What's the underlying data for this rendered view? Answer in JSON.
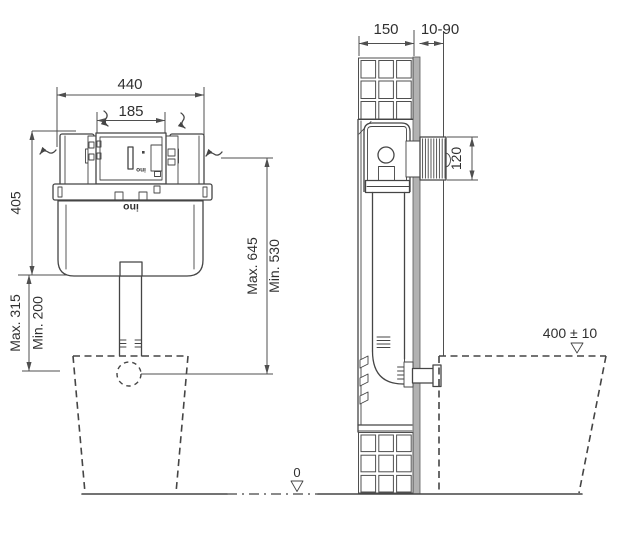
{
  "front_view": {
    "dim_frame_width": "440",
    "dim_access_width": "185",
    "dim_frame_height": "405",
    "dim_outlet_max": "Max. 315",
    "dim_outlet_min": "Min. 200",
    "dim_overall_max": "Max. 645",
    "dim_overall_min": "Min. 530",
    "brand": "ino"
  },
  "side_view": {
    "dim_frame_depth": "150",
    "dim_wall_finish_range": "10-90",
    "dim_flush_plate_height": "120",
    "dim_bowl_rim_height": "400 ± 10",
    "dim_floor_datum": "0"
  },
  "colors": {
    "line": "#454545",
    "dim_line": "#4f4f4f",
    "text": "#303030",
    "wall_fill": "#b2b2b2",
    "background": "#ffffff"
  }
}
